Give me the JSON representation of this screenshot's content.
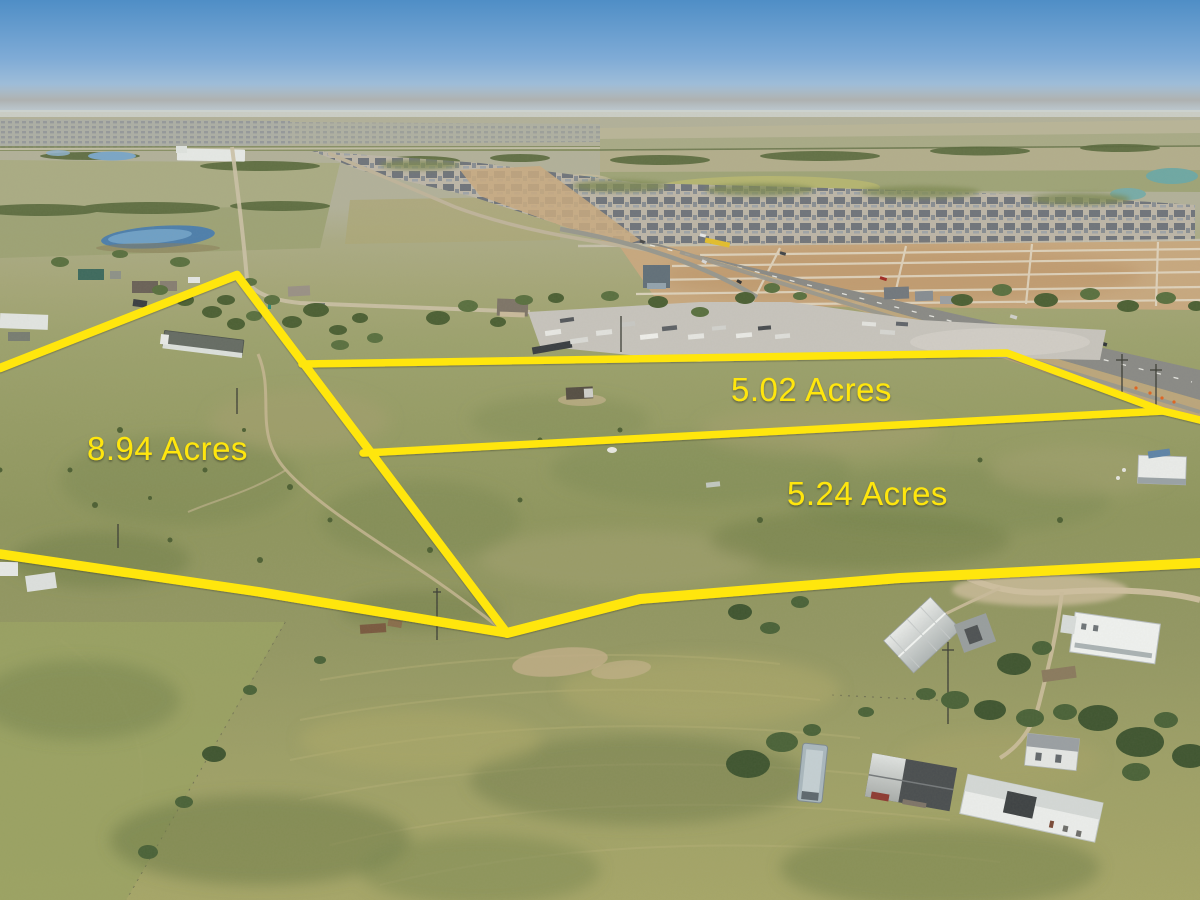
{
  "scene": {
    "description": "Aerial drone photo of rural acreage with a distant suburban development, outlined land parcels marked in yellow"
  },
  "overlay": {
    "line_color": "#FFE60E",
    "label_color": "#FFE60E",
    "parcels": [
      {
        "label": "8.94 Acres"
      },
      {
        "label": "5.02 Acres"
      },
      {
        "label": "5.24 Acres"
      }
    ]
  }
}
